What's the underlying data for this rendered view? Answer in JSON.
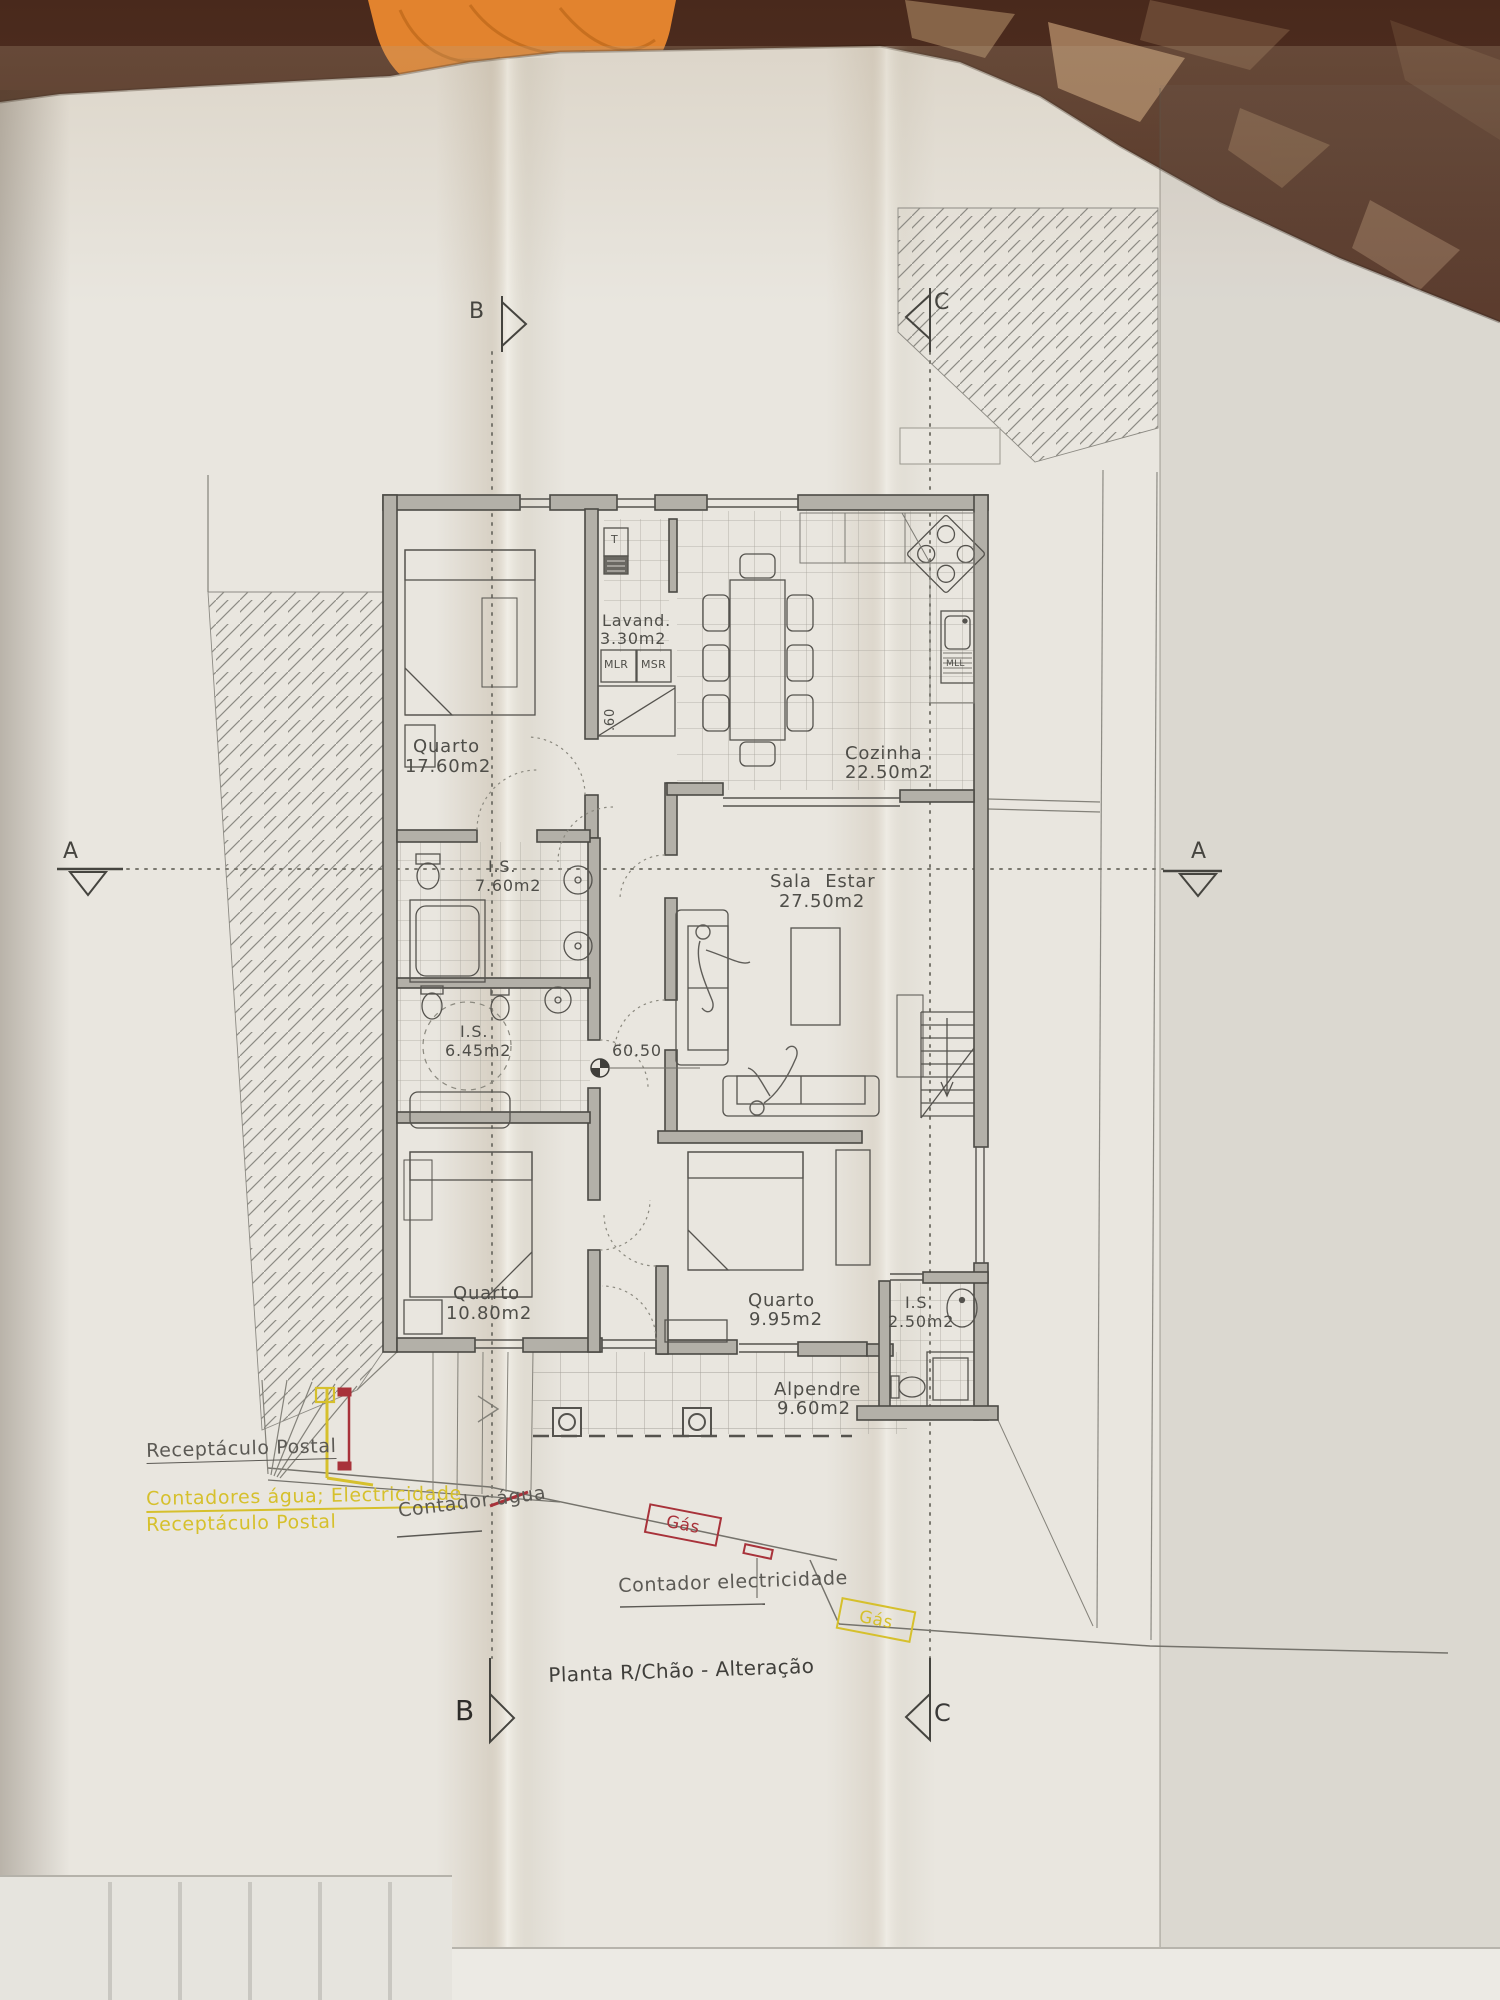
{
  "title": "Planta R/Chão - Alteração",
  "plan": {
    "rooms": [
      {
        "name": "Quarto",
        "area": "17.60m2"
      },
      {
        "name": "Lavand.",
        "area": "3.30m2"
      },
      {
        "name": "Cozinha",
        "area": "22.50m2"
      },
      {
        "name": "I.S.",
        "area": "7.60m2"
      },
      {
        "name": "Sala Estar",
        "area": "27.50m2"
      },
      {
        "name": "I.S.",
        "area": "6.45m2"
      },
      {
        "name": "Quarto",
        "area": "10.80m2"
      },
      {
        "name": "Quarto",
        "area": "9.95m2"
      },
      {
        "name": "I.S.",
        "area": "2.50m2"
      },
      {
        "name": "Alpendre",
        "area": "9.60m2"
      }
    ],
    "appliances": {
      "t": "T",
      "mlr": "MLR",
      "msr": "MSR",
      "mll": "MLL"
    },
    "levels": {
      "floor_level": "60.50",
      "step_height": ".60"
    },
    "sections": {
      "a": "A",
      "b": "B",
      "c": "C"
    }
  },
  "annotations": {
    "receptaculo_gray": "Receptáculo Postal",
    "contadores_yellow": "Contadores água; Electricidade",
    "receptaculo_yellow": "Receptáculo Postal",
    "contador_agua": "Contador água",
    "gas_red": "Gás",
    "contador_elec": "Contador electricidade",
    "gas_yellow": "Gás"
  },
  "colors": {
    "annotation_yellow": "#d6c02c",
    "annotation_red": "#a8323a",
    "plan_ink": "#4a4a46",
    "paper": "#e9e6df"
  }
}
